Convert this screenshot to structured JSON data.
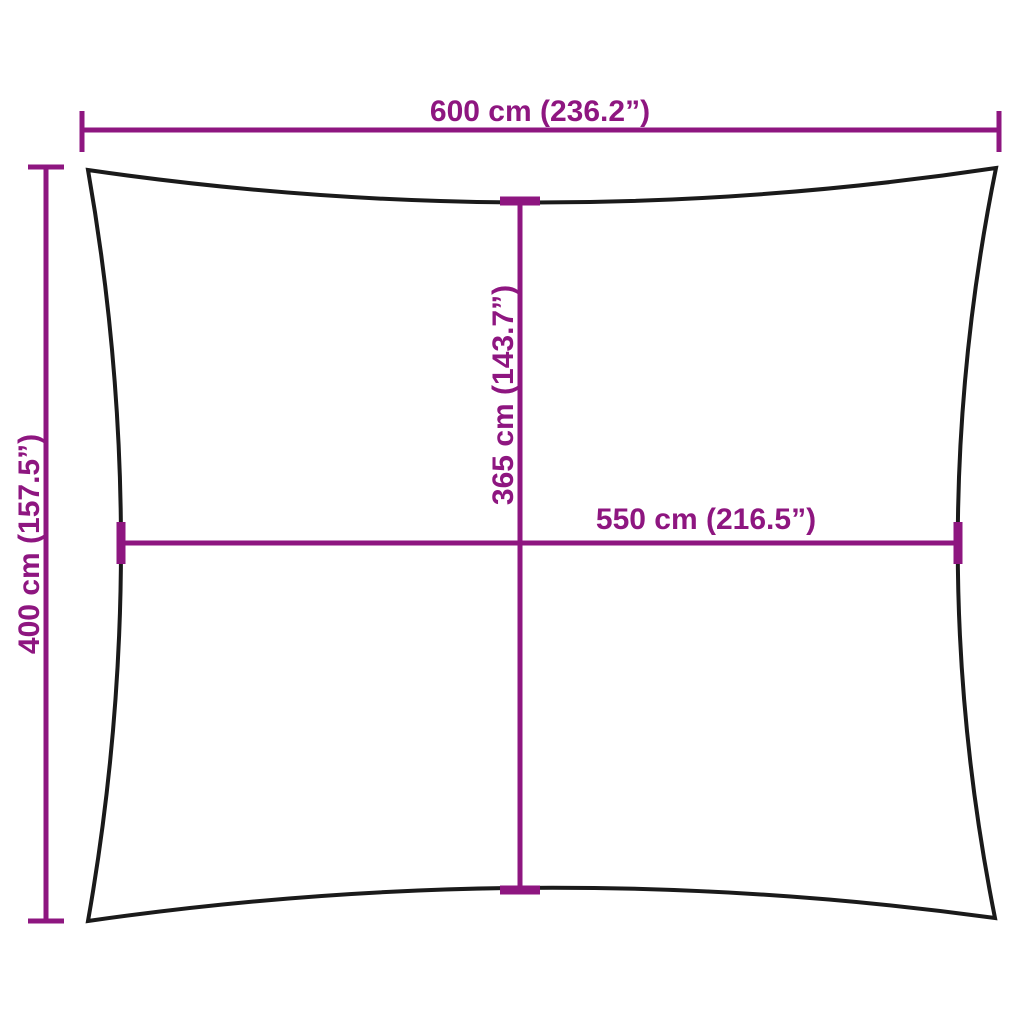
{
  "diagram": {
    "name": "shade-sail-dimension-diagram",
    "colors": {
      "dimension": "#8E1680",
      "outline": "#1A1A1A",
      "background": "#FFFFFF"
    },
    "dimensions": {
      "top_width": {
        "label": "600 cm (236.2”)",
        "value_cm": 600,
        "value_inch": 236.2,
        "orientation": "horizontal"
      },
      "left_height": {
        "label": "400 cm (157.5”)",
        "value_cm": 400,
        "value_inch": 157.5,
        "orientation": "vertical"
      },
      "center_height": {
        "label": "365 cm (143.7”)",
        "value_cm": 365,
        "value_inch": 143.7,
        "orientation": "vertical"
      },
      "center_width": {
        "label": "550 cm (216.5”)",
        "value_cm": 550,
        "value_inch": 216.5,
        "orientation": "horizontal"
      }
    }
  }
}
